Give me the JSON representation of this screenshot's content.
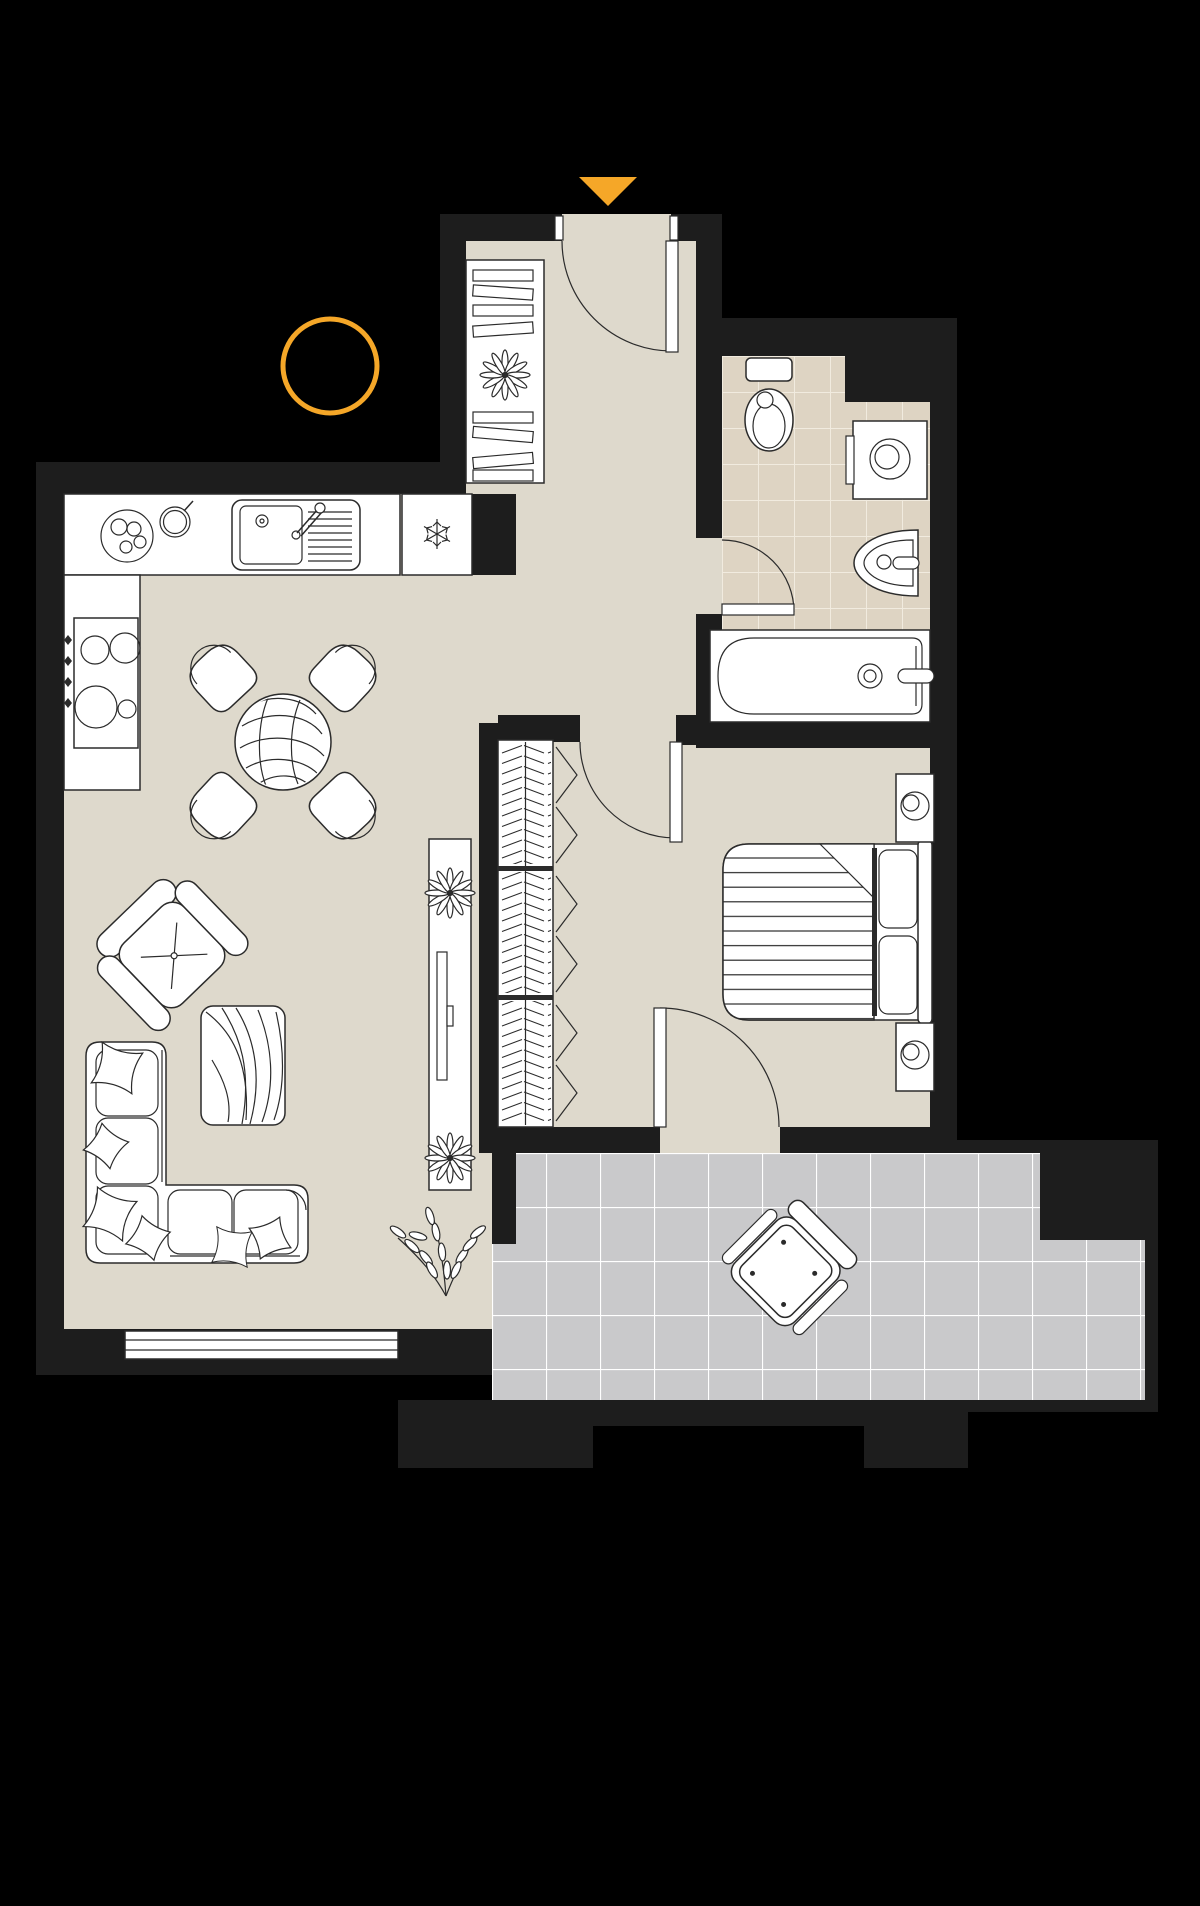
{
  "document": {
    "kind": "apartment-floor-plan",
    "view": "top-down",
    "visible_text": []
  },
  "colors": {
    "background": "#000000",
    "wall": "#1d1d1d",
    "floor": "#ded9cc",
    "bath_tile": "#ded4c3",
    "balcony_tile": "#c9c9cb",
    "line": "#2b2b2b",
    "furniture": "#ffffff",
    "accent": "#f5a728",
    "grout_bath": "#f1ebdf",
    "grout_balcony": "#ffffff"
  },
  "annotations": {
    "entry_arrow": "yellow triangle pointing down at entrance door",
    "highlight_circle": "yellow ring on black background left of hallway"
  },
  "rooms": [
    {
      "name": "hallway",
      "floor": "beige",
      "furniture": [
        "entry-door",
        "bookshelf-with-books",
        "potted-plant"
      ]
    },
    {
      "name": "bathroom",
      "floor": "beige-tiles",
      "furniture": [
        "toilet",
        "washing-machine",
        "washbasin",
        "bathtub",
        "swing-door"
      ]
    },
    {
      "name": "kitchen",
      "floor": "beige",
      "furniture": [
        "countertop",
        "double-sink-with-faucet",
        "plate",
        "pot",
        "fridge-freezer-snowflake",
        "stove-four-burners",
        "four-knobs"
      ]
    },
    {
      "name": "dining-area",
      "floor": "beige",
      "furniture": [
        "round-wood-table",
        "chair",
        "chair",
        "chair",
        "chair"
      ]
    },
    {
      "name": "living-room",
      "floor": "beige",
      "furniture": [
        "armchair-rotated",
        "wood-coffee-table",
        "corner-sofa",
        "six-pillows",
        "tv-console",
        "tv",
        "plant-starburst",
        "plant-starburst",
        "branch-plant",
        "window"
      ]
    },
    {
      "name": "bedroom",
      "floor": "beige",
      "furniture": [
        "wardrobe-3-sections-hanging-clothes",
        "swing-door",
        "double-bed",
        "striped-blanket-folded-corner",
        "pillow",
        "pillow",
        "headboard",
        "nightstand-with-lamp",
        "nightstand-with-lamp",
        "balcony-door"
      ]
    },
    {
      "name": "balcony",
      "floor": "gray-tiles",
      "furniture": [
        "lounge-chair-rotated"
      ]
    }
  ],
  "counts": {
    "doors": 5,
    "rooms": 7,
    "wardrobe_sections": 3,
    "dining_chairs": 4,
    "sofa_pillows": 6
  }
}
